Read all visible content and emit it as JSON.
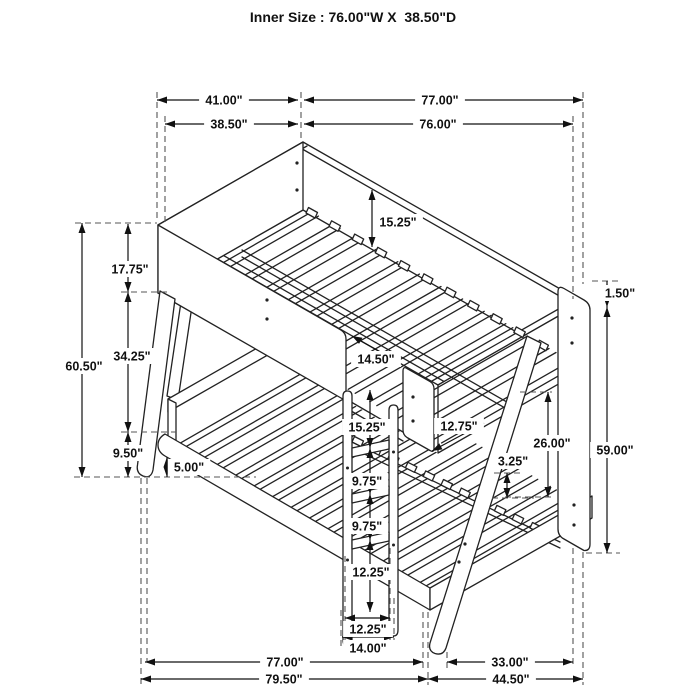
{
  "title": "Inner Size : 76.00\"W X  38.50\"D",
  "dimensions": {
    "upper_depth_outer": "41.00\"",
    "upper_length_outer": "77.00\"",
    "upper_depth_inner": "38.50\"",
    "upper_length_inner": "76.00\"",
    "overall_height": "60.50\"",
    "upper_rail_height": "17.75\"",
    "bunk_gap_height": "34.25\"",
    "lower_rail_floor_height": "9.50\"",
    "lower_rail_bottom_clearance": "5.00\"",
    "upper_rail_to_slats": "15.25\"",
    "ladder_opening_width": "14.50\"",
    "ladder_top_step": "15.25\"",
    "ladder_step_spacing_1": "9.75\"",
    "ladder_step_spacing_2": "9.75\"",
    "ladder_bottom_step": "12.25\"",
    "ladder_inner_width": "12.25\"",
    "ladder_outer_width": "14.00\"",
    "guard_panel_gap": "12.75\"",
    "lower_bunk_clearance": "26.00\"",
    "lower_slat_height": "3.25\"",
    "rail_top_offset": "1.50\"",
    "side_frame_height": "59.00\"",
    "lower_length_inner": "77.00\"",
    "side_frame_depth": "33.00\"",
    "lower_length_outer": "79.50\"",
    "lower_depth_outer": "44.50\""
  }
}
